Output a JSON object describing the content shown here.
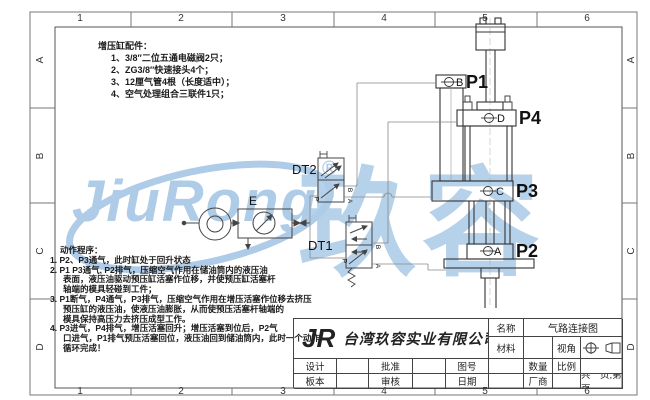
{
  "frame": {
    "columns": [
      "1",
      "2",
      "3",
      "4",
      "5",
      "6"
    ],
    "rows": [
      "A",
      "B",
      "C",
      "D"
    ]
  },
  "watermark": {
    "latin": "JiuRong",
    "registered": "®",
    "cjk": "玖容",
    "color": "#aecbe7"
  },
  "accessories": {
    "title": "增压缸配件：",
    "items": [
      "1、3/8″二位五通电磁阀2只；",
      "2、ZG3/8″快速接头4个；",
      "3、12厘气管4根（长度适中）；",
      "4、空气处理组合三联件1只；"
    ]
  },
  "action": {
    "title": "动作程序：",
    "lines": [
      "1. P2、P3通气，此时缸处于回升状态",
      "2. P1 P3通气, P2排气，压缩空气作用在储油筒内的液压油",
      "表面，液压油驱动预压缸活塞作位移，并使预压缸活塞杆",
      "轴端的模具轻碰到工件；",
      "3. P1断气，P4通气，P3排气，压缩空气作用在增压活塞作位移去挤压",
      "预压缸的液压油，使液压油膨胀，从而使预压活塞杆轴端的",
      "模具保持高压力去挤压成型工作。",
      "4. P3进气，P4排气，增压活塞回升；增压活塞到位后，P2气",
      "口进气，P1排气预压活塞回位，液压油回到储油筒内，此时一个动作",
      "循环完成！"
    ]
  },
  "schematic": {
    "air_unit_label": "E",
    "valves": {
      "dt1": "DT1",
      "dt2": "DT2"
    },
    "valve_ports": {
      "p": "P",
      "a": "A",
      "b": "B"
    },
    "cylinder_ports": {
      "p1": "P1",
      "p2": "P2",
      "p3": "P3",
      "p4": "P4"
    },
    "port_letters": {
      "a": "A",
      "b": "B",
      "c": "C",
      "d": "D"
    }
  },
  "title_block": {
    "logo": "JR",
    "company": "台湾玖容实业有限公司",
    "name_label": "名称",
    "name_value": "气路连接图",
    "material_label": "材料",
    "view_label": "视角",
    "design_label": "设计",
    "approve_label": "批准",
    "drawno_label": "图号",
    "qty_label": "数量",
    "scale_label": "比例",
    "version_label": "板本",
    "review_label": "审核",
    "date_label": "日期",
    "vendor_label": "厂商",
    "pages_label": "共　页,第　页"
  }
}
